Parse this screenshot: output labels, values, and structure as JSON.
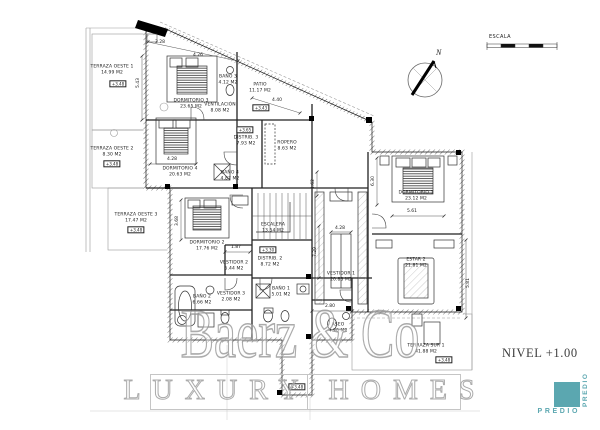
{
  "annotations": {
    "level": "NIVEL +1.00",
    "scale": "ESCALA",
    "north": "N"
  },
  "brand": {
    "watermark": "Baerz & Co",
    "watermark2": "LUXURY HOMES",
    "logo": "PREDIO",
    "logo_color": "#5BA7B0"
  },
  "plan": {
    "labels": [
      {
        "t": "TERRAZA OESTE 1\n14.99 M2",
        "x": 112,
        "y": 70,
        "c": "room"
      },
      {
        "t": "+3.48",
        "x": 118,
        "y": 84,
        "c": "elev"
      },
      {
        "t": "TERRAZA OESTE 2\n8.30 M2",
        "x": 112,
        "y": 152,
        "c": "room"
      },
      {
        "t": "+3.48",
        "x": 112,
        "y": 164,
        "c": "elev"
      },
      {
        "t": "TERRAZA OESTE 3\n17.47 M2",
        "x": 136,
        "y": 218,
        "c": "room"
      },
      {
        "t": "+3.48",
        "x": 136,
        "y": 230,
        "c": "elev"
      },
      {
        "t": "DORMITORIO 3\n23.65 M2",
        "x": 191,
        "y": 104,
        "c": "room"
      },
      {
        "t": "BAÑO 3\n4.12 M2",
        "x": 228,
        "y": 80,
        "c": "room"
      },
      {
        "t": "VENTILACIÓN\n8.08 M2",
        "x": 220,
        "y": 108,
        "c": "room"
      },
      {
        "t": "PATIO\n11.17 M2",
        "x": 260,
        "y": 88,
        "c": "room"
      },
      {
        "t": "+3.43",
        "x": 261,
        "y": 108,
        "c": "elev"
      },
      {
        "t": "+3.65",
        "x": 245,
        "y": 130,
        "c": "elev"
      },
      {
        "t": "DISTRIB. 3\n7.93 M2",
        "x": 246,
        "y": 141,
        "c": "room"
      },
      {
        "t": "ROPERO\n8.63 M2",
        "x": 287,
        "y": 146,
        "c": "room"
      },
      {
        "t": "DORMITORIO 4\n20.63 M2",
        "x": 180,
        "y": 172,
        "c": "room"
      },
      {
        "t": "BAÑO 4\n4.87 M2",
        "x": 230,
        "y": 176,
        "c": "room"
      },
      {
        "t": "DORMITORIO 2\n17.76 M2",
        "x": 207,
        "y": 246,
        "c": "room"
      },
      {
        "t": "VESTIDOR 2\n5.44 M2",
        "x": 234,
        "y": 266,
        "c": "room"
      },
      {
        "t": "VESTIDOR 3\n2.08 M2",
        "x": 231,
        "y": 297,
        "c": "room"
      },
      {
        "t": "BAÑO 2\n6.66 M2",
        "x": 202,
        "y": 300,
        "c": "room"
      },
      {
        "t": "ESCALERA\n13.54 M2",
        "x": 273,
        "y": 228,
        "c": "room"
      },
      {
        "t": "+3.30",
        "x": 268,
        "y": 250,
        "c": "elev"
      },
      {
        "t": "DISTRIB. 2\n8.72 M2",
        "x": 270,
        "y": 262,
        "c": "room"
      },
      {
        "t": "VESTIDOR 1\n20.83 M2",
        "x": 341,
        "y": 277,
        "c": "room"
      },
      {
        "t": "DORMITORIO 1\n23.12 M2",
        "x": 416,
        "y": 196,
        "c": "room"
      },
      {
        "t": "ESTAR 2\n21.81 M2",
        "x": 416,
        "y": 263,
        "c": "room"
      },
      {
        "t": "BAÑO 1\n5.01 M2",
        "x": 281,
        "y": 292,
        "c": "room"
      },
      {
        "t": "ASEO\n4.20 M2",
        "x": 338,
        "y": 328,
        "c": "room"
      },
      {
        "t": "TERRAZA SUR 1\n41.88 M2",
        "x": 426,
        "y": 349,
        "c": "room"
      },
      {
        "t": "+3.48",
        "x": 444,
        "y": 360,
        "c": "elev"
      },
      {
        "t": "+3.48",
        "x": 297,
        "y": 387,
        "c": "elev"
      },
      {
        "t": "3.28",
        "x": 160,
        "y": 43,
        "c": "dim"
      },
      {
        "t": "4.26",
        "x": 198,
        "y": 56,
        "c": "dim"
      },
      {
        "t": "5.43",
        "x": 139,
        "y": 83,
        "c": "dim",
        "rot": -90
      },
      {
        "t": "4.40",
        "x": 277,
        "y": 101,
        "c": "dim"
      },
      {
        "t": "4.28",
        "x": 172,
        "y": 160,
        "c": "dim"
      },
      {
        "t": "3.68",
        "x": 178,
        "y": 221,
        "c": "dim",
        "rot": -90
      },
      {
        "t": "1.87",
        "x": 236,
        "y": 248,
        "c": "dim"
      },
      {
        "t": "4.28",
        "x": 340,
        "y": 229,
        "c": "dim"
      },
      {
        "t": "7.29",
        "x": 316,
        "y": 252,
        "c": "dim",
        "rot": -90
      },
      {
        "t": "1.62",
        "x": 314,
        "y": 184,
        "c": "dim",
        "rot": -90
      },
      {
        "t": "5.61",
        "x": 412,
        "y": 212,
        "c": "dim"
      },
      {
        "t": "6.30",
        "x": 374,
        "y": 181,
        "c": "dim",
        "rot": -90
      },
      {
        "t": "2.80",
        "x": 330,
        "y": 307,
        "c": "dim"
      },
      {
        "t": "5.81",
        "x": 469,
        "y": 283,
        "c": "dim",
        "rot": -90
      }
    ]
  }
}
